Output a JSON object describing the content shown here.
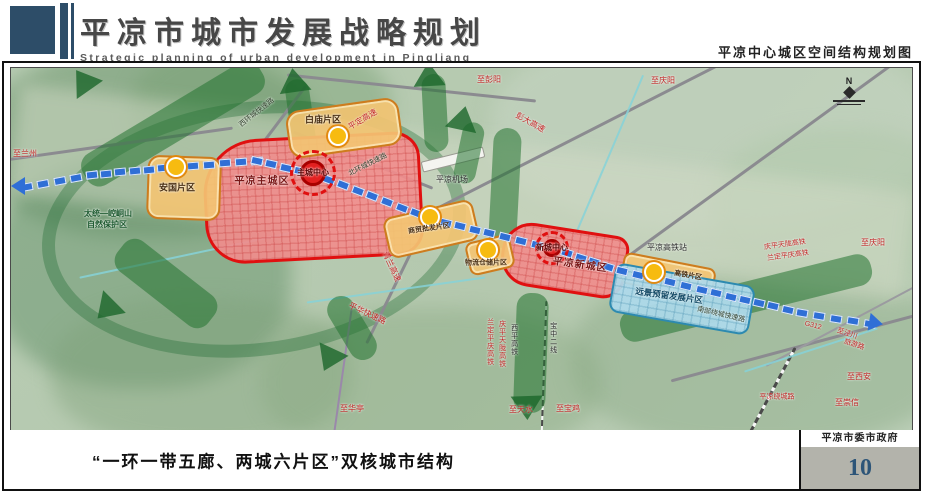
{
  "header": {
    "title": "平凉市城市发展战略规划",
    "subtitle": "Strategic planning of urban development in Pingliang",
    "map_name": "平凉中心城区空间结构规划图"
  },
  "footer": {
    "caption": "“一环一带五廊、两城六片区”双核城市结构",
    "org": "平凉市委市政府",
    "page_number": "10"
  },
  "map": {
    "compass": "N",
    "labels": [
      {
        "id": "to-lanzhou",
        "text": "至兰州"
      },
      {
        "id": "to-pengyang",
        "text": "至彭阳"
      },
      {
        "id": "to-qingyang-top",
        "text": "至庆阳"
      },
      {
        "id": "pengda-expwy",
        "text": "彭大高速"
      },
      {
        "id": "pingding-expwy",
        "text": "平定高速"
      },
      {
        "id": "north-ring-road",
        "text": "北环城快速路"
      },
      {
        "id": "west-ring-road",
        "text": "西环城快速路"
      },
      {
        "id": "baimiao",
        "text": "白庙片区"
      },
      {
        "id": "anguo",
        "text": "安国片区"
      },
      {
        "id": "main-city",
        "text": "平凉主城区"
      },
      {
        "id": "main-center",
        "text": "主城中心"
      },
      {
        "id": "commerce",
        "text": "商贸批发片区"
      },
      {
        "id": "logistics",
        "text": "物流仓储片区"
      },
      {
        "id": "new-city",
        "text": "平凉新城区"
      },
      {
        "id": "new-center",
        "text": "新城中心"
      },
      {
        "id": "hsr-station",
        "text": "平凉高铁站"
      },
      {
        "id": "hsr-district",
        "text": "高铁片区"
      },
      {
        "id": "reserve",
        "text": "远景预留发展片区"
      },
      {
        "id": "qinglan-expwy",
        "text": "青兰高速"
      },
      {
        "id": "pinghua-expwy",
        "text": "平华快速路"
      },
      {
        "id": "qingping-tianlong-hsr-e",
        "text": "庆平天陇高铁"
      },
      {
        "id": "landing-pingqing-hsr-e",
        "text": "兰定平庆高铁"
      },
      {
        "id": "to-qingyang-right",
        "text": "至庆阳"
      },
      {
        "id": "g312",
        "text": "G312"
      },
      {
        "id": "to-jingchuan",
        "text": "至泾川"
      },
      {
        "id": "tour-road",
        "text": "旅游路"
      },
      {
        "id": "to-xian",
        "text": "至西安"
      },
      {
        "id": "to-chongxin",
        "text": "至崇信"
      },
      {
        "id": "landing-pingqing-hsr-s",
        "text": "兰定平庆高铁"
      },
      {
        "id": "qingping-tianlong-hsr-s",
        "text": "庆平天陇高铁"
      },
      {
        "id": "xiping-hsr",
        "text": "西平高铁"
      },
      {
        "id": "baozhong-line2",
        "text": "宝中二线"
      },
      {
        "id": "to-huating",
        "text": "至华亭"
      },
      {
        "id": "to-tianshui",
        "text": "至天水"
      },
      {
        "id": "to-baoji",
        "text": "至宝鸡"
      },
      {
        "id": "south-ring-road",
        "text": "南部绕城快速路"
      },
      {
        "id": "airport",
        "text": "平凉机场"
      },
      {
        "id": "nature-reserve-1",
        "text": "太统—崆峒山"
      },
      {
        "id": "nature-reserve-2",
        "text": "自然保护区"
      },
      {
        "id": "ring-road-br",
        "text": "平凉绕城路"
      }
    ]
  },
  "colors": {
    "header_blue": "#2d4d68",
    "accent_red": "#e01010",
    "district_orange": "#cd7c1e",
    "axis_blue": "#2f6fd6",
    "corridor_green": "#2e7d42",
    "reserve_blue": "#2d8ab0",
    "page_number_blue": "#2d5578"
  }
}
